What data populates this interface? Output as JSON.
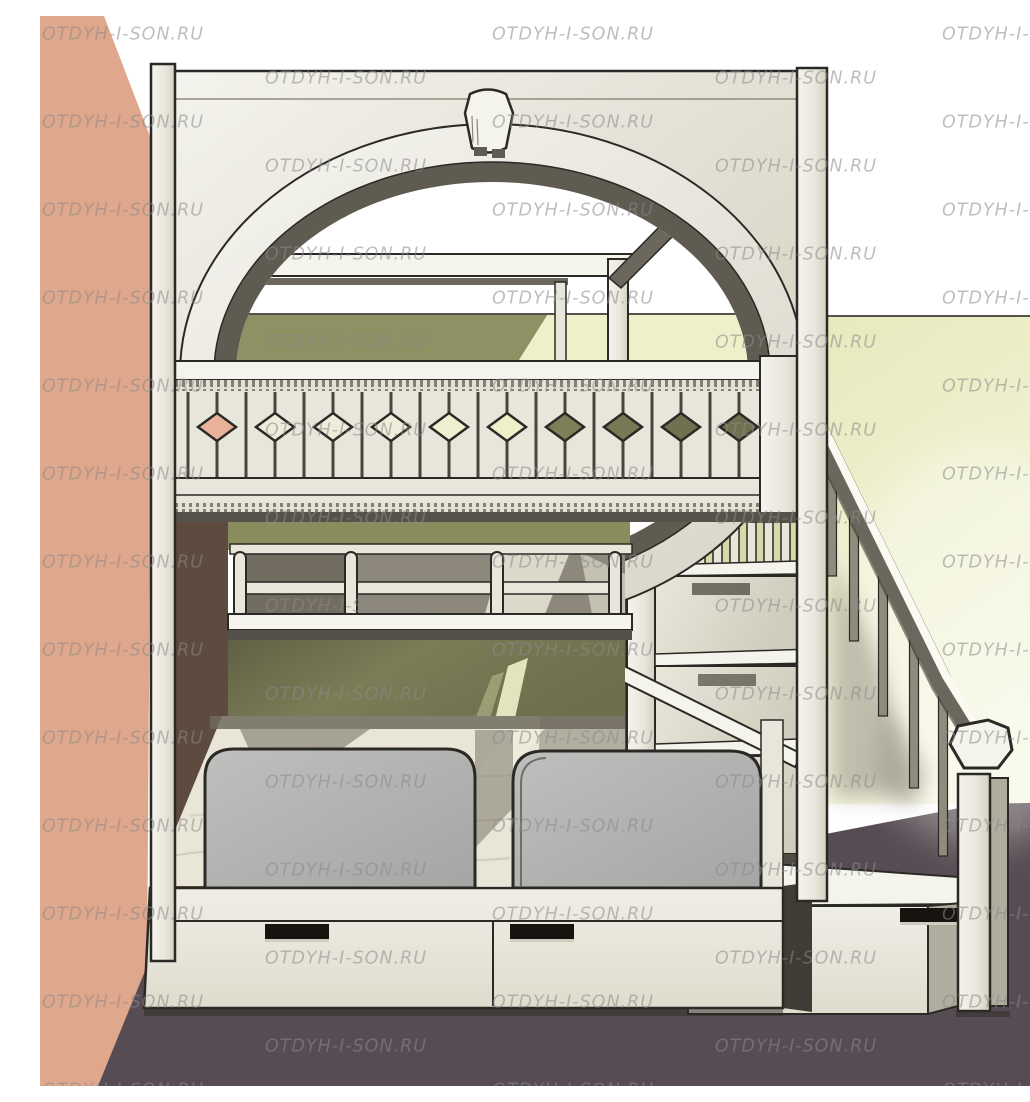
{
  "image": {
    "kind": "3d-furniture-render",
    "subject": "Children's loft bunk bed render: arched canopy top bunk with slatted balustrade and diamond cutouts, lower double bed with two gray rounded headboards, storage drawers in the base, and a side staircase with handrail and newel post, set in a room corner with salmon and pale-yellow walls"
  },
  "watermark": {
    "text": "OTDYH-I-SON.RU",
    "color": "#8a8a8a",
    "opacity": 0.55,
    "font_size": 17.5,
    "row_spacing": 44,
    "col_spacing": 450,
    "odd_row_offset": 225,
    "rows": 25,
    "start_y": 6
  },
  "palette": {
    "wall-salmon": "#dfa78c",
    "wall-white": "#ffffff",
    "wall-yellow-1": "#e7e9bd",
    "wall-yellow-2": "#f7f8e3",
    "olive-upper": "#8e9164",
    "olive-strip": "#8a8c5e",
    "olive-lower-1": "#7b7d57",
    "olive-lower-2": "#5f6144",
    "floor": "#574c53",
    "cream-1": "#f4f3ec",
    "cream-2": "#e8e6da",
    "cream-3": "#d8d5c6",
    "wood-dark": "#6b675c",
    "band-dark": "#5f5b51",
    "outline": "#2b2925",
    "headboard-1": "#bcbcba",
    "headboard-2": "#a7a7a5",
    "mattress": "#e9e6d7",
    "shadow": "#6f6a5d",
    "soft-shadow": "#8a8577",
    "handle": "#17140f",
    "brown-side": "#5e4b3f",
    "step-side": "#b1ad9e",
    "fence-gap": "#d8d9a8",
    "canopy-yellow": "#eff0ca"
  },
  "diamond_fills": [
    "#e7b298",
    "#efedda",
    "#efedda",
    "#efeeda",
    "#f0efd2",
    "#eff0c9",
    "#7d7f58",
    "#777955",
    "#6f7150",
    "#6f7150"
  ]
}
